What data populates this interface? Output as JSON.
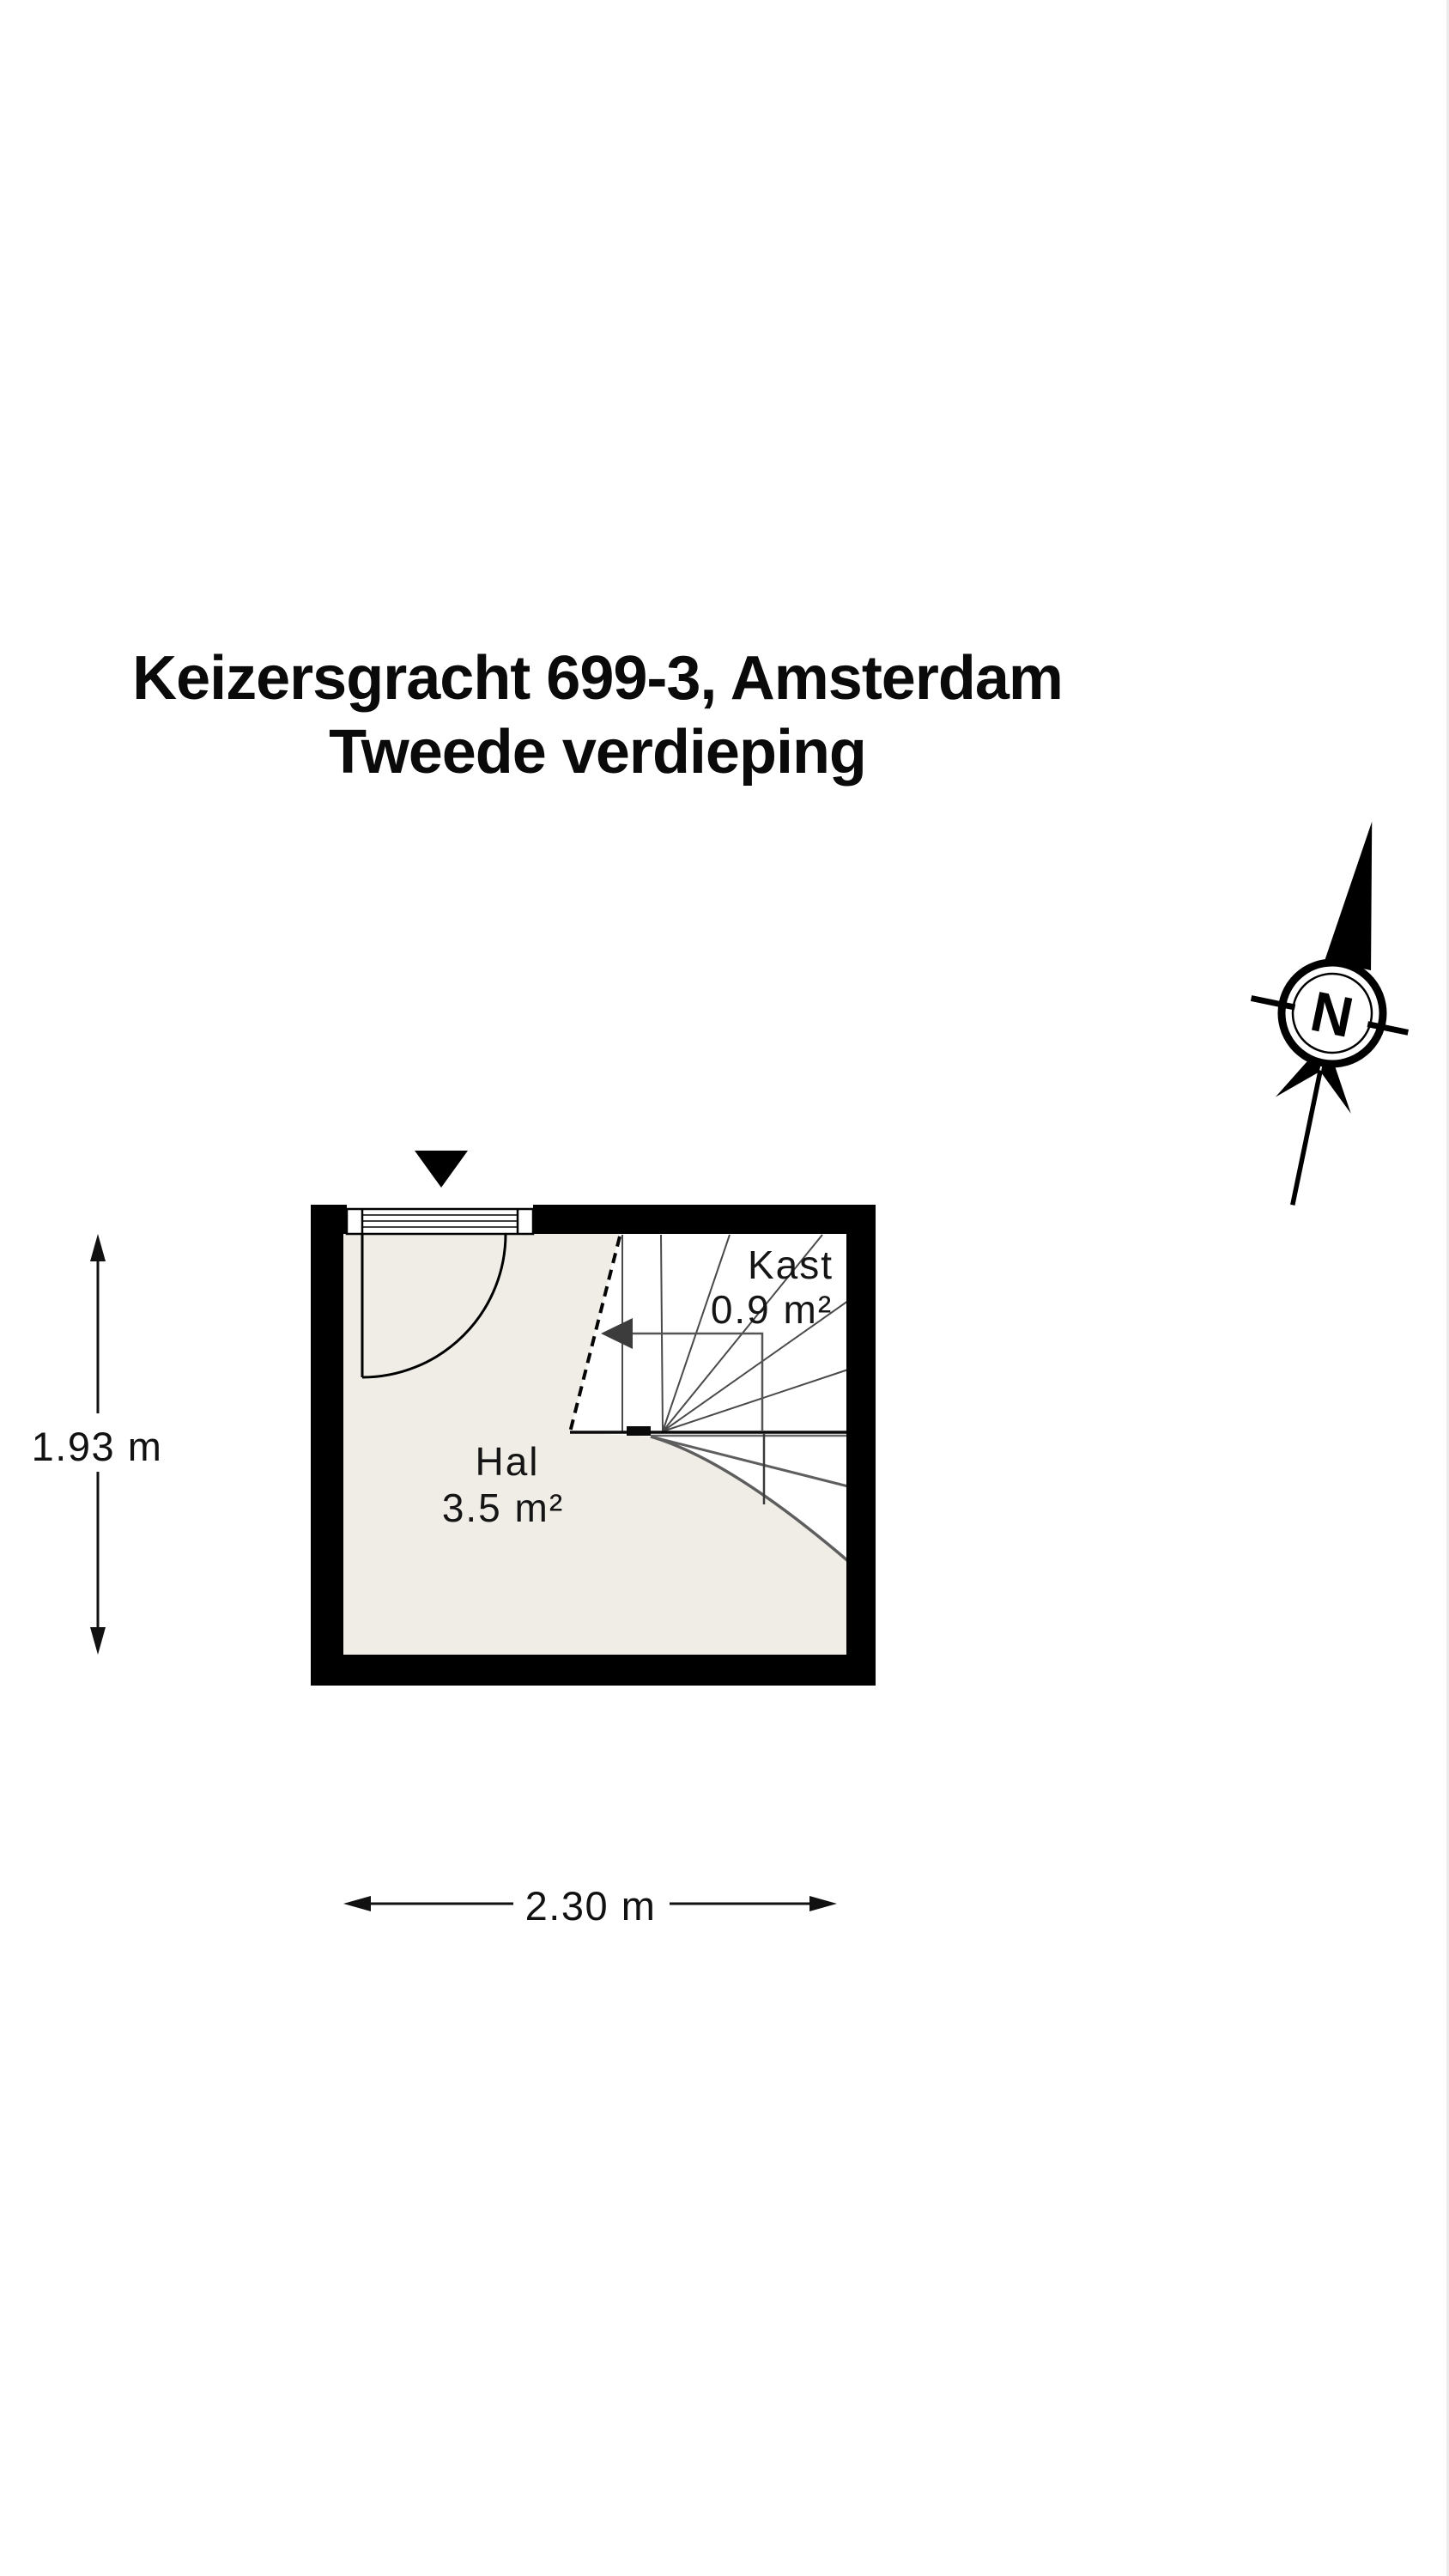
{
  "title": {
    "line1": "Keizersgracht 699-3, Amsterdam",
    "line2": "Tweede verdieping"
  },
  "compass": {
    "letter": "N"
  },
  "rooms": [
    {
      "name": "Hal",
      "area": "3.5 m²"
    },
    {
      "name": "Kast",
      "area": "0.9 m²"
    }
  ],
  "dimensions": {
    "height_label": "1.93 m",
    "width_label": "2.30 m"
  },
  "colors": {
    "wall": "#000000",
    "floor": "#efede6",
    "stair_line": "#4a4a4a",
    "lower_stair_line": "#5e5e5e",
    "text": "#111111",
    "background": "#ffffff"
  }
}
